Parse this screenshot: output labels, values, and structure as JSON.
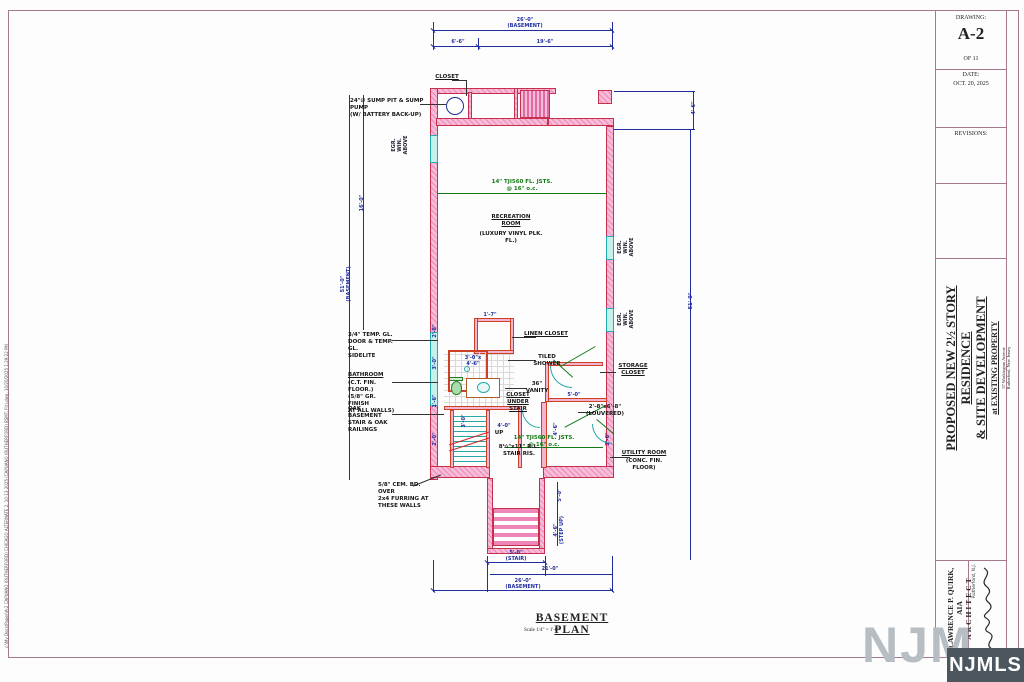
{
  "sheet": {
    "plot_stamp": "c:\\My Docs\\Paper\\A-2 CAPUANO (RUTHERFORD) CHICAGO ALTERNATE 2, 10-13-2025 (CAPUANO (RUTHERFORD) BSMT. Flr).dwg, 10/20/2025 1:29:22 PM"
  },
  "title_block": {
    "drawing_label": "DRAWING:",
    "drawing_number": "A-2",
    "sheet_of": "OF 11",
    "date_label": "DATE:",
    "date_value": "OCT. 20, 2025",
    "revisions_label": "REVISIONS:",
    "project_title_1": "PROPOSED NEW 2½ STORY RESIDENCE",
    "project_title_2": "& SITE DEVELOPMENT",
    "project_title_3": "at EXISTING PROPERTY",
    "project_address_1": "57 Washington Avenue",
    "project_address_2": "Rutherford, New Jersey",
    "architect_name": "LAWRENCE P. QUIRK, AIA",
    "architect_title": "ARCHITECT",
    "architect_location": "Rutherford, N.J."
  },
  "plan": {
    "title": "BASEMENT PLAN",
    "scale_note": "Scale 1/4\" = 1'-0\"",
    "labels": {
      "closet": "CLOSET",
      "sump": "24\"∅ SUMP PIT & SUMP PUMP\n(W/ BATTERY BACK-UP)",
      "recreation": "RECREATION\nROOM",
      "recreation_sub": "(LUXURY VINYL PLK. FL.)",
      "joists": "14\" TJI560 FL. JSTS.\n@ 16\" o.c.",
      "linen": "LINEN CLOSET",
      "shower": "TILED\nSHOWER",
      "shower_size": "3'-0\"x\n4'-6\"",
      "vanity": "36\"\nVANITY",
      "storage": "STORAGE\nCLOSET",
      "under_stair": "CLOSET\nUNDER\nSTAIR",
      "louvered": "2'-8\"x6'-8\"\n(LOUVERED)",
      "utility": "UTILITY ROOM",
      "utility_sub": "(CONC. FIN. FLOOR)",
      "stair_risers": "8½\"x11\" R.L.\nSTAIR RIS.",
      "up": "UP",
      "temp_glass": "3/4\" TEMP. GL.\nDOOR & TEMP. GL.\nSIDELITE",
      "bathroom_name": "BATHROOM",
      "bathroom_sub": "(C.T. FIN. FLOOR.)\n(5/8\" GR. FINISH\nAT ALL WALLS)",
      "oak_stair": "OAK BASEMENT\nSTAIR & OAK\nRAILINGS",
      "cement_board": "5/8\" CEM. BD. OVER\n2x4 FURRING AT\nTHESE WALLS",
      "egress_window": "EGR. WIN.\nABOVE"
    },
    "dimensions": {
      "top_total": "26'-0\"\n(BASEMENT)",
      "top_left": "6'-6\"",
      "top_right": "19'-6\"",
      "right_upper": "4'-6\"",
      "left_total": "51'-0\"\n(BASEMENT)",
      "left_inner": "16'-0\"",
      "right_total": "51'-0\"",
      "bottom_stair": "5'-0\"\n(STAIR)",
      "bottom_inner": "21'-0\"",
      "bottom_total": "26'-0\"\n(BASEMENT)",
      "stairwell_depth": "5'-0\"",
      "stairwell_steps": "4'-6\"\n(STEP UP)",
      "d_linen": "1'-7\"",
      "d_understair": "4'-0\"",
      "d_storage": "5'-0\"",
      "d_utility": "4'-6\"",
      "d_door": "2'-6\"",
      "d_stair_width": "3'-0\"",
      "d_left1": "2'-8\"",
      "d_left2": "3'-0\"",
      "d_left3": "1'-6\"",
      "d_left4": "2'-0\""
    },
    "colors": {
      "wall_pink": "#f7bcd6",
      "wall_line": "#c62f4e",
      "window_cyan": "#c4f1ec",
      "dimension_blue": "#1f2d9e",
      "joist_green": "#157a15",
      "badge_bg": "#4b565f"
    }
  },
  "watermark": {
    "ghost": "NJM",
    "badge": "NJMLS"
  }
}
